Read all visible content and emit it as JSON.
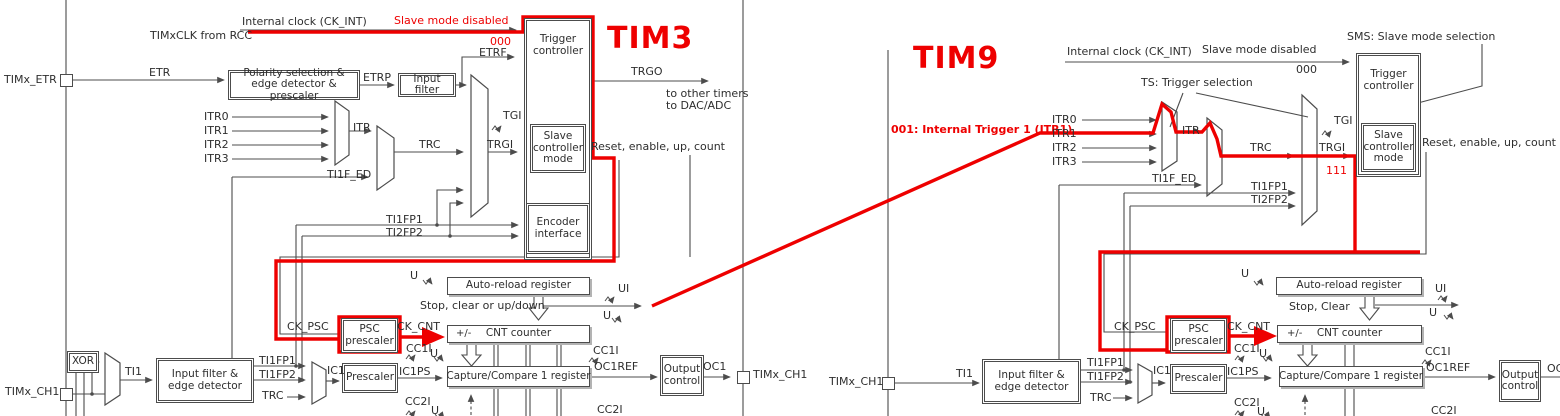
{
  "colors": {
    "annotation_red": "#ee0000",
    "line_gray": "#4c4c4c",
    "text": "#2e2e2e"
  },
  "tim3": {
    "title": "TIM3",
    "internal_clock": "Internal clock (CK_INT)",
    "timxclk_from_rcc": "TIMxCLK from RCC",
    "slave_mode_disabled": "Slave mode disabled",
    "smd_bits": "000",
    "etrf": "ETRF",
    "etr": "ETR",
    "pin_etr": "TIMx_ETR",
    "polarity_box": "Polarity selection & edge detector & prescaler",
    "etrp": "ETRP",
    "input_filter_box": "Input filter",
    "itr0": "ITR0",
    "itr1": "ITR1",
    "itr2": "ITR2",
    "itr3": "ITR3",
    "itr": "ITR",
    "ti1f_ed": "TI1F_ED",
    "trc": "TRC",
    "tgi": "TGI",
    "trgi": "TRGI",
    "trigger_controller_box": "Trigger controller",
    "slave_controller_box": "Slave controller mode",
    "encoder_box": "Encoder interface",
    "trgo": "TRGO",
    "trgo_dest": "to other timers\nto DAC/ADC",
    "reset_enable": "Reset, enable, up, count",
    "ti1fp1_trig": "TI1FP1",
    "ti2fp2_trig": "TI2FP2",
    "u_arr": "U",
    "auto_reload_box": "Auto-reload register",
    "stop_clear": "Stop, clear or up/down",
    "ui": "UI",
    "u_update": "U",
    "ck_psc": "CK_PSC",
    "psc_box": "PSC prescaler",
    "ck_cnt": "CK_CNT",
    "plus_minus": "+/-",
    "cnt_box": "CNT counter",
    "cc1i_left": "CC1I",
    "u_cc1i": "U",
    "ic1ps": "IC1PS",
    "capture_box": "Capture/Compare 1 register",
    "cc1i_right": "CC1I",
    "oc1ref": "OC1REF",
    "output_control_box": "Output control",
    "oc1": "OC1",
    "pin_ch1_out": "TIMx_CH1",
    "xor_box": "XOR",
    "ti1": "TI1",
    "pin_ch1": "TIMx_CH1",
    "input_filter_ed_box": "Input filter & edge detector",
    "ti1fp1": "TI1FP1",
    "ti1fp2": "TI1FP2",
    "trc_ch": "TRC",
    "ic1": "IC1",
    "prescaler_box": "Prescaler",
    "cc2i_left": "CC2I",
    "u_cc2i": "U",
    "cc2i_right": "CC2I"
  },
  "tim9": {
    "title": "TIM9",
    "annotation_itr1": "001: Internal Trigger 1 (ITR1)",
    "internal_clock": "Internal clock (CK_INT)",
    "slave_mode_disabled": "Slave mode disabled",
    "smd_bits": "000",
    "sms_note": "SMS: Slave mode selection",
    "ts_note": "TS: Trigger selection",
    "itr0": "ITR0",
    "itr1": "ITR1",
    "itr2": "ITR2",
    "itr3": "ITR3",
    "itr": "ITR",
    "ti1f_ed": "TI1F_ED",
    "trc": "TRC",
    "tgi": "TGI",
    "trgi": "TRGI",
    "ts_bits": "111",
    "ti1fp1_trig": "TI1FP1",
    "ti2fp2_trig": "TI2FP2",
    "trigger_controller_box": "Trigger controller",
    "slave_controller_box": "Slave controller mode",
    "reset_enable": "Reset, enable, up, count",
    "u_arr": "U",
    "auto_reload_box": "Auto-reload register",
    "stop_clear": "Stop, Clear",
    "ui": "UI",
    "u_update": "U",
    "ck_psc": "CK_PSC",
    "psc_box": "PSC prescaler",
    "ck_cnt": "CK_CNT",
    "plus_minus": "+/-",
    "cnt_box": "CNT counter",
    "cc1i_left": "CC1I",
    "u_cc1i": "U",
    "ic1ps": "IC1PS",
    "capture_box": "Capture/Compare 1 register",
    "cc1i_right": "CC1I",
    "oc1ref": "OC1REF",
    "output_control_box": "Output control",
    "oc1": "OC1",
    "pin_ch1": "TIMx_CH1",
    "ti1": "TI1",
    "input_filter_ed_box": "Input filter & edge detector",
    "ti1fp1": "TI1FP1",
    "ti1fp2": "TI1FP2",
    "trc_ch": "TRC",
    "ic1": "IC1",
    "prescaler_box": "Prescaler",
    "cc2i_left": "CC2I",
    "u_cc2i": "U",
    "cc2i_right": "CC2I"
  }
}
